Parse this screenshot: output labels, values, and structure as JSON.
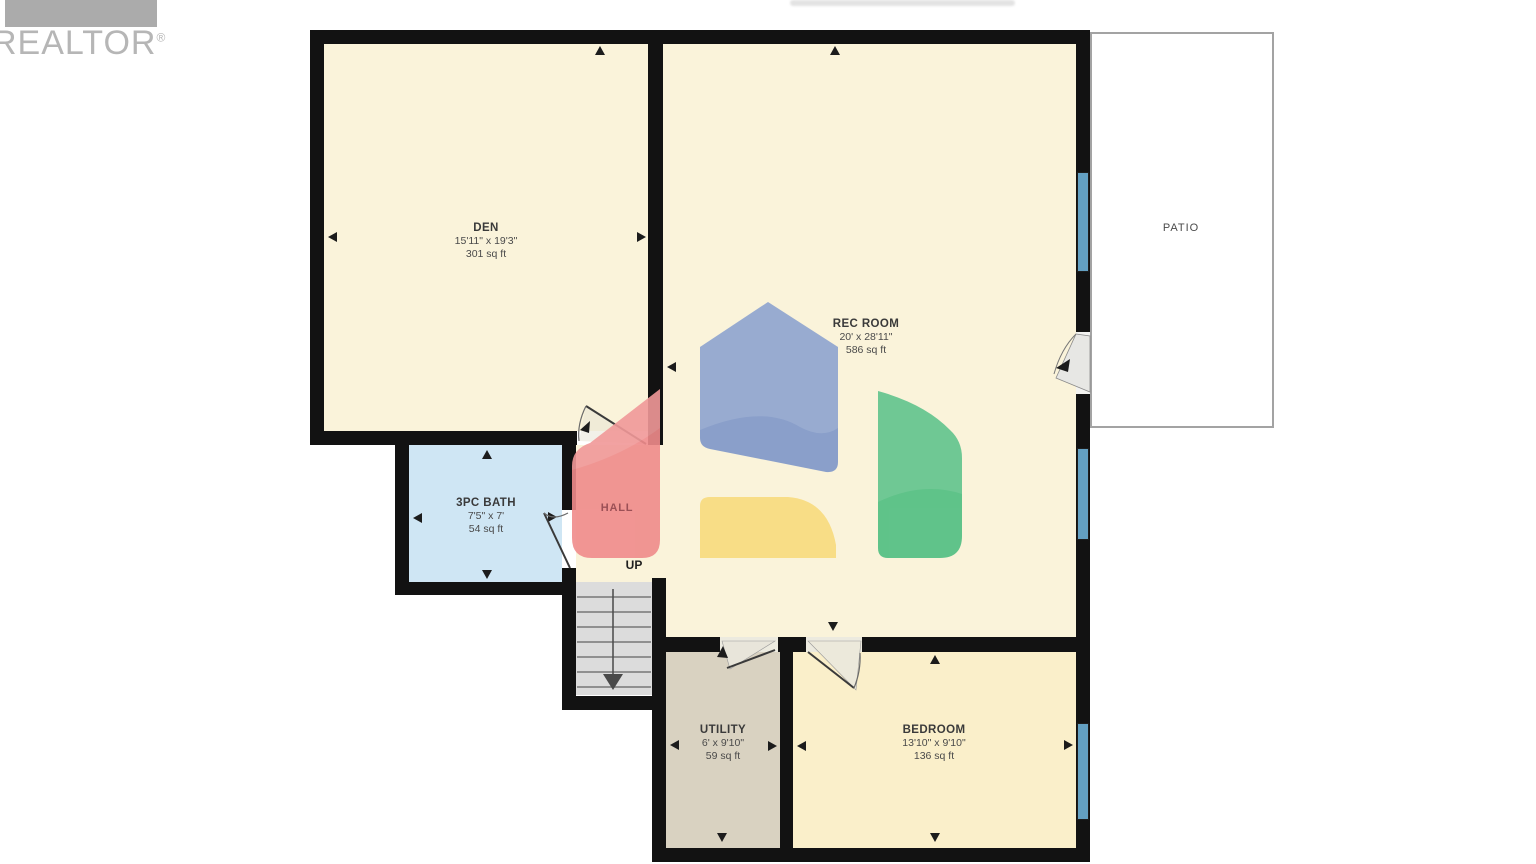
{
  "branding": {
    "realtor": "REALTOR",
    "reg": "®"
  },
  "rooms": {
    "den": {
      "name": "DEN",
      "dims": "15'11\" x 19'3\"",
      "area": "301 sq ft"
    },
    "rec_room": {
      "name": "REC ROOM",
      "dims": "20' x 28'11\"",
      "area": "586 sq ft"
    },
    "bath": {
      "name": "3PC BATH",
      "dims": "7'5\" x 7'",
      "area": "54 sq ft"
    },
    "hall": {
      "name": "HALL"
    },
    "utility": {
      "name": "UTILITY",
      "dims": "6' x 9'10\"",
      "area": "59 sq ft"
    },
    "bedroom": {
      "name": "BEDROOM",
      "dims": "13'10\" x 9'10\"",
      "area": "136 sq ft"
    },
    "patio": {
      "name": "PATIO"
    }
  },
  "stairs": {
    "label": "UP"
  },
  "colors": {
    "wall": "#121212",
    "room_cream": "#faf3da",
    "bedroom_cream": "#faefca",
    "bath_blue": "#cfe6f4",
    "utility_tan": "#d9d2c1",
    "stairs_gray": "#dcdcdc",
    "window_blue": "#63a0c2",
    "patio_border": "#a3a3a3",
    "watermark_red": "#f08b8b",
    "watermark_blue": "#7e97c9",
    "watermark_green": "#4fbe81",
    "watermark_yellow": "#f8db7d",
    "hall_text": "#9b5056",
    "logo_gray": "#b6b6b6"
  }
}
